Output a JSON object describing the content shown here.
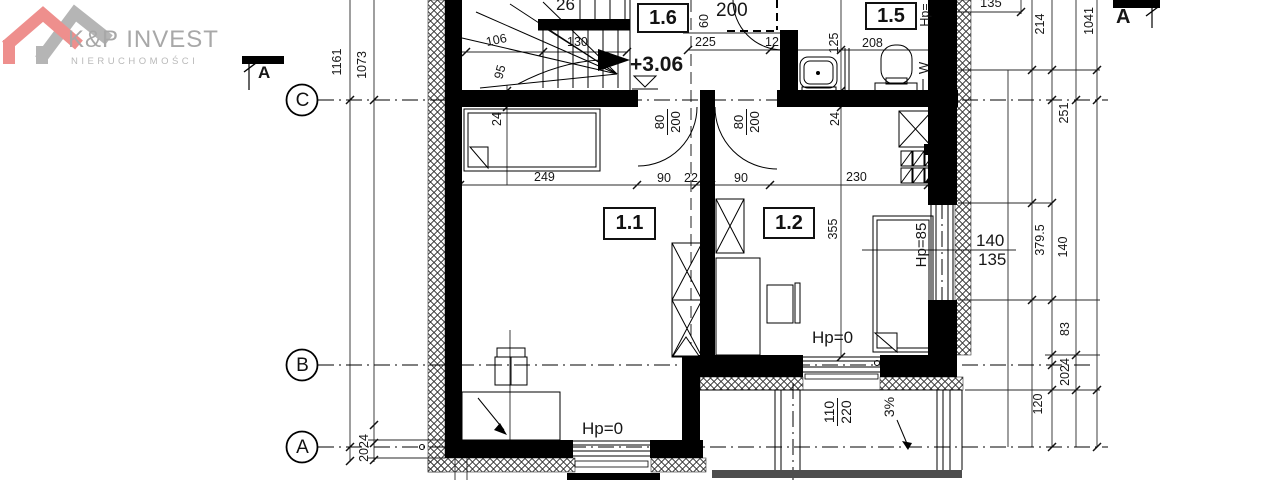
{
  "logo": {
    "title": "K&P INVEST",
    "subtitle": "NIERUCHOMOŚCI"
  },
  "section_markers": {
    "left_label": "A",
    "right_label": "A"
  },
  "grid_axes": {
    "c": "C",
    "b": "B",
    "a": "A"
  },
  "rooms": {
    "r16": "1.6",
    "r15": "1.5",
    "r11": "1.1",
    "r12": "1.2"
  },
  "level_marker": {
    "value": "+3.06"
  },
  "stairs": {
    "step_count": "26",
    "dim_106": "106",
    "dim_130": "130",
    "dim_95": "95"
  },
  "doors": {
    "door1_width": "80",
    "door1_height": "200",
    "door2_width": "80",
    "door2_height": "200",
    "door3_width": "80",
    "door3_height": "200"
  },
  "dims": {
    "left": {
      "v1161": "1161",
      "v1073": "1073",
      "v2024": "2024"
    },
    "top": {
      "v60": "60",
      "v225": "225",
      "v12": "12",
      "v125": "125",
      "v208": "208",
      "v135": "135"
    },
    "right": {
      "v214": "214",
      "v1041": "1041",
      "v251": "251",
      "v379_5": "379.5",
      "v140": "140",
      "v83": "83",
      "v2024": "2024",
      "v120": "120"
    },
    "interior": {
      "v249": "249",
      "v90a": "90",
      "v22": "22",
      "v90b": "90",
      "v230": "230",
      "v24a": "24",
      "v24b": "24",
      "v355": "355"
    }
  },
  "windows": {
    "w140": "140",
    "w135": "135",
    "hp85": "Hp=85",
    "hp0_room12": "Hp=0",
    "hp0_room11": "Hp=0",
    "hp_top": "Hp="
  },
  "balcony": {
    "door_width": "110",
    "door_height": "220",
    "slope": "3%"
  },
  "vent": {
    "label": "W"
  },
  "colors": {
    "roof_pink": "#ee8f8d",
    "roof_gray": "#b5b5b5",
    "logo_text": "#a8a8a8",
    "ink": "#111111"
  }
}
